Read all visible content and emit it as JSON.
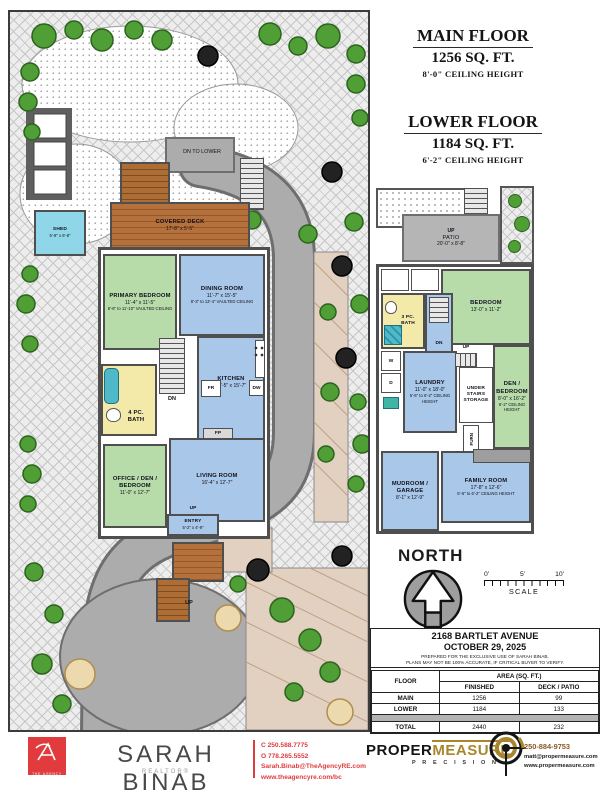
{
  "titles": {
    "main": {
      "name": "MAIN FLOOR",
      "area": "1256 SQ. FT.",
      "ceiling": "8'-0\" CEILING HEIGHT"
    },
    "lower": {
      "name": "LOWER FLOOR",
      "area": "1184 SQ. FT.",
      "ceiling": "6'-2\" CEILING HEIGHT"
    }
  },
  "labels": {
    "up": "UP",
    "dn": "DN",
    "dn_to_lower": "DN TO LOWER",
    "fr": "FR",
    "dw": "DW",
    "fp": "FP",
    "w": "W",
    "d": "D",
    "furn": "FURN"
  },
  "site": {
    "shed_name": "SHED",
    "shed_dims": "5'-8\" x 6'-8\""
  },
  "main_floor": {
    "covered_deck": {
      "name": "COVERED DECK",
      "dims": "17'-8\" x 5'-5\""
    },
    "primary_bedroom": {
      "name": "PRIMARY BEDROOM",
      "dims": "11'-4\" x 11'-5\"",
      "ceiling": "8'-6\" to 11'-10\" VAULTED CEILING"
    },
    "dining_room": {
      "name": "DINING ROOM",
      "dims": "11'-7\" x 15'-5\"",
      "ceiling": "8'-3\" to 13'-4\" VAULTED CEILING"
    },
    "kitchen": {
      "name": "KITCHEN",
      "dims": "11'-5\" x 15'-7\""
    },
    "bath": {
      "name": "4 PC. BATH"
    },
    "office": {
      "name": "OFFICE / DEN / BEDROOM",
      "dims": "11'-0\" x 12'-7\""
    },
    "living_room": {
      "name": "LIVING ROOM",
      "dims": "16'-4\" x 12'-7\""
    },
    "entry": {
      "name": "ENTRY",
      "dims": "5'-2\" x 4'-9\""
    }
  },
  "lower_floor": {
    "patio": {
      "name": "PATIO",
      "dims": "20'-0\" x 8'-8\""
    },
    "bedroom": {
      "name": "BEDROOM",
      "dims": "13'-0\" x 11'-2\""
    },
    "bath": {
      "name": "3 PC. BATH"
    },
    "laundry": {
      "name": "LAUNDRY",
      "dims": "11'-0\" x 18'-0\"",
      "ceiling": "5'-6\" to 6'-2\" CEILING HEIGHT"
    },
    "under_stairs": {
      "name": "UNDER STAIRS STORAGE"
    },
    "den_bedroom": {
      "name": "DEN / BEDROOM",
      "dims": "8'-0\" x 16'-2\"",
      "ceiling": "6'-2\" CEILING HEIGHT"
    },
    "mudroom": {
      "name": "MUDROOM / GARAGE",
      "dims": "8'-1\" x 12'-9\""
    },
    "family_room": {
      "name": "FAMILY ROOM",
      "dims": "17'-8\" x 12'-6\"",
      "ceiling": "5'-6\" to 6'-2\" CEILING HEIGHT"
    }
  },
  "compass": {
    "label": "NORTH"
  },
  "scale_bar": {
    "tick0": "0'",
    "tick5": "5'",
    "tick10": "10'",
    "label": "SCALE"
  },
  "info_table": {
    "address": "2168 BARTLET AVENUE",
    "date": "OCTOBER 29, 2025",
    "note1": "PREPARED FOR THE EXCLUSIVE USE OF SARAH BINAB.",
    "note2": "PLANS MAY NOT BE 100% ACCURATE, IF CRITICAL BUYER TO VERIFY.",
    "col_floor": "FLOOR",
    "col_area": "AREA (SQ. FT.)",
    "col_finished": "FINISHED",
    "col_deck": "DECK / PATIO",
    "rows": [
      {
        "floor": "MAIN",
        "finished": "1256",
        "deck": "99"
      },
      {
        "floor": "LOWER",
        "finished": "1184",
        "deck": "133"
      }
    ],
    "total": {
      "floor": "TOTAL",
      "finished": "2440",
      "deck": "232"
    }
  },
  "footer": {
    "agency_logo_text": "THE AGENCY",
    "agent_name": "SARAH BINAB",
    "agent_title": "REALTOR®",
    "contact_lines": [
      "C 250.588.7775",
      "O 778.265.5552",
      "Sarah.Binab@TheAgencyRE.com",
      "www.theagencyre.com/bc"
    ],
    "pm_word1": "PROPER",
    "pm_word2": "MEASURE",
    "pm_tagline": "P R E C I S I O N",
    "pm_contact_lines": [
      "250-884-9753",
      "matt@propermeasure.com",
      "www.propermeasure.com"
    ]
  },
  "colors": {
    "agency_red": "#e13b3e",
    "pm_gold": "#a8872c",
    "room_blue": "#a9c7e8",
    "room_green": "#b7dcaa",
    "bath_yellow": "#f3e9a9",
    "deck_brown": "#b06f3a",
    "patio_gray": "#b5b5b5",
    "wall_gray": "#4f4f4f"
  }
}
